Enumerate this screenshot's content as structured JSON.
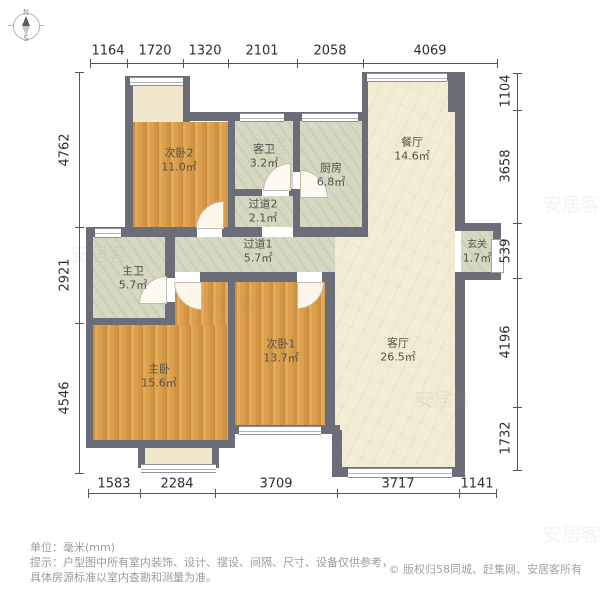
{
  "meta": {
    "unit_label": "单位：毫米(mm)",
    "hint_line1": "提示：户型图中所有室内装饰、设计、摆设、间隔、尺寸、设备仅供参考，",
    "hint_line2": "具体房源标准以室内查勘和测量为准。",
    "copyright": "© 版权归58同城、赶集网、安居客所有"
  },
  "compass": {
    "north": "N",
    "south": "S"
  },
  "dimensions": {
    "top": [
      "1164",
      "1720",
      "1320",
      "2101",
      "2058",
      "4069"
    ],
    "left": [
      "4762",
      "2921",
      "4546"
    ],
    "right": [
      "1104",
      "3658",
      "539",
      "4196",
      "1732"
    ],
    "bottom": [
      "1583",
      "2284",
      "3709",
      "3717",
      "1141"
    ]
  },
  "rooms": {
    "bedroom2": {
      "name": "次卧2",
      "area": "11.0㎡"
    },
    "bath2": {
      "name": "客卫",
      "area": "3.2㎡"
    },
    "kitchen": {
      "name": "厨房",
      "area": "6.8㎡"
    },
    "dining": {
      "name": "餐厅",
      "area": "14.6㎡"
    },
    "hallway2": {
      "name": "过道2",
      "area": "2.1㎡"
    },
    "hallway1": {
      "name": "过道1",
      "area": "5.7㎡"
    },
    "bath1": {
      "name": "主卫",
      "area": "5.7㎡"
    },
    "entry": {
      "name": "玄关",
      "area": "1.7㎡"
    },
    "master": {
      "name": "主卧",
      "area": "15.6㎡"
    },
    "bedroom1": {
      "name": "次卧1",
      "area": "13.7㎡"
    },
    "living": {
      "name": "客厅",
      "area": "26.5㎡"
    }
  },
  "colors": {
    "wall": "#6b6e78",
    "bedroom_fill": "#dca04c",
    "wet_fill": "#d6d8c2",
    "living_fill": "#f3ecd4",
    "balcony_fill": "#f0e7cd",
    "dim_text": "#2e2e30",
    "footer_text": "#9b9b9b"
  },
  "watermark": "安居客"
}
